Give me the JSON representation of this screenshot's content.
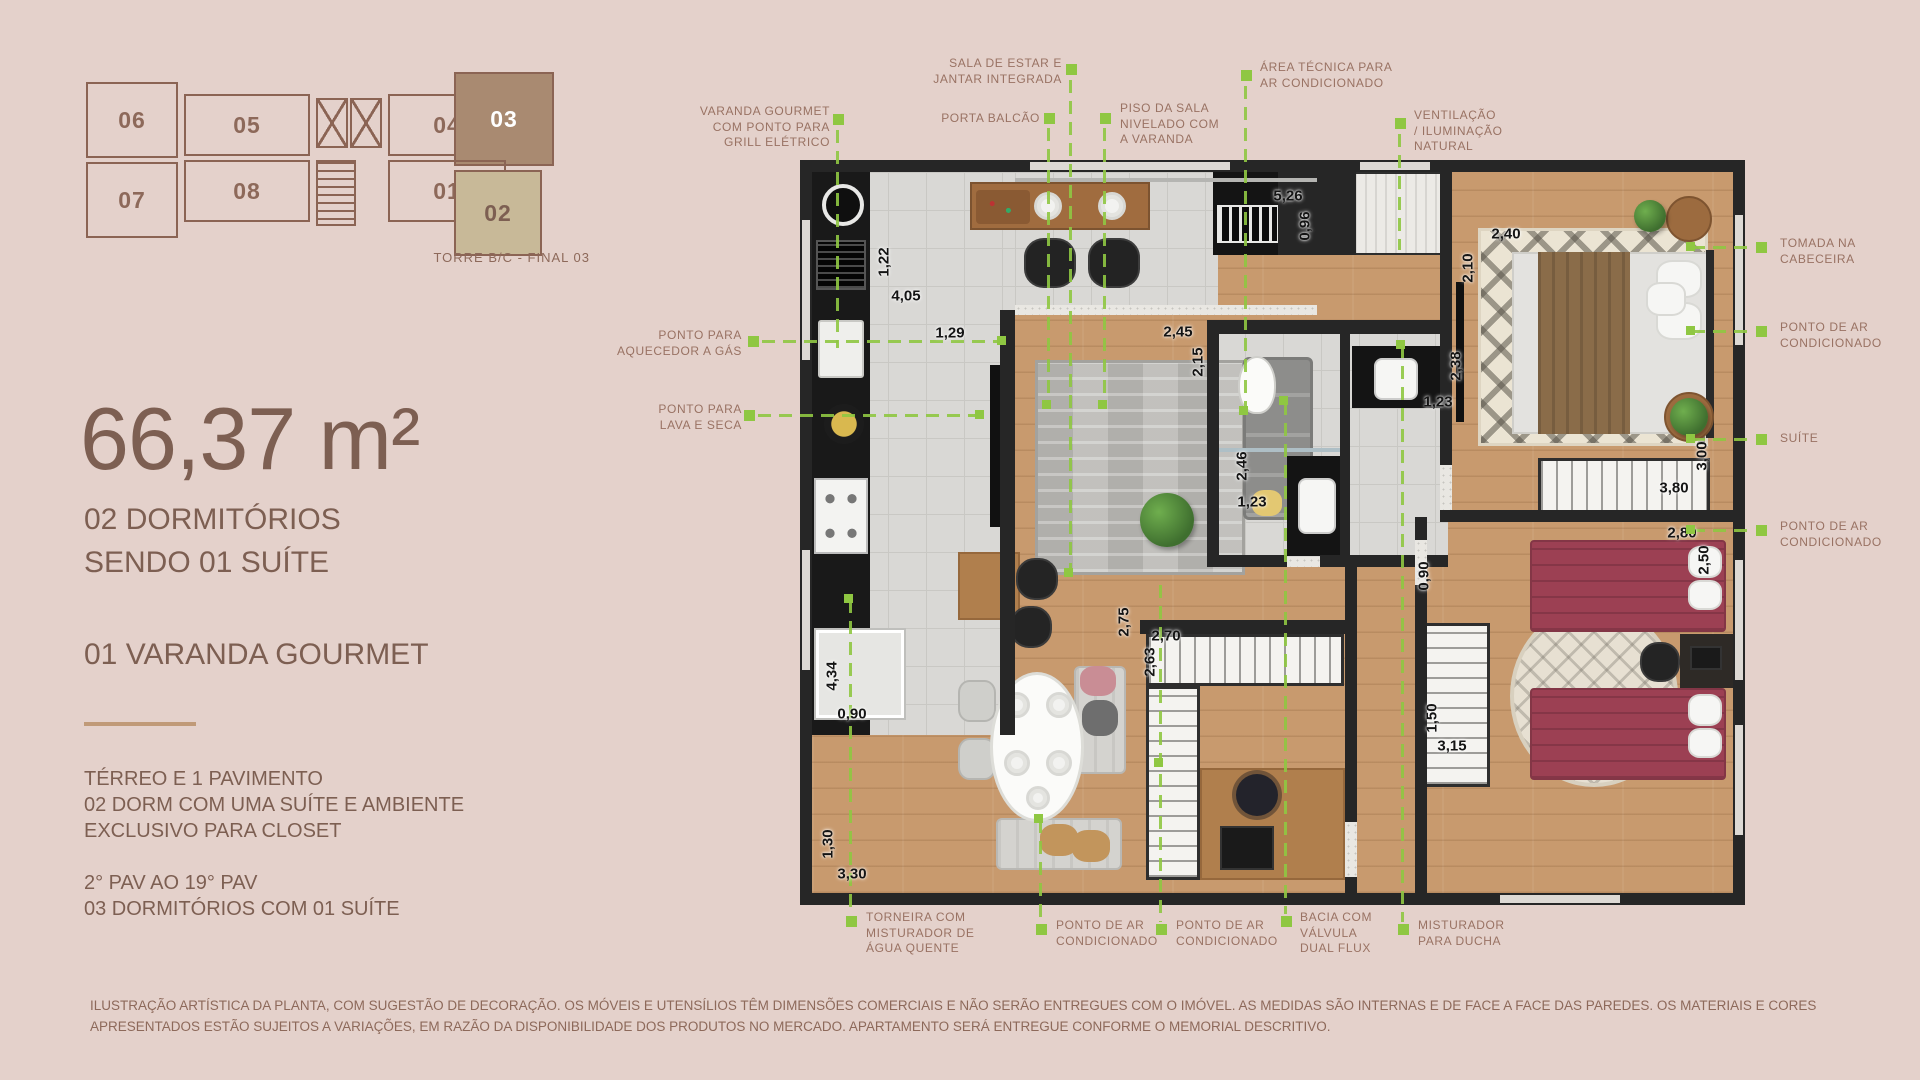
{
  "palette": {
    "background": "#e4d1cb",
    "text_primary": "#7d5f52",
    "text_muted": "#997263",
    "accent_green": "#8fc742",
    "wall": "#262626",
    "unit_highlight": "#a98a71",
    "unit_secondary": "#c8b998"
  },
  "key_plan": {
    "caption": "TORRE B/C - FINAL 03",
    "units": [
      {
        "label": "06",
        "x": 16,
        "y": 16,
        "w": 92,
        "h": 76,
        "style": "outline"
      },
      {
        "label": "05",
        "x": 114,
        "y": 28,
        "w": 126,
        "h": 62,
        "style": "outline"
      },
      {
        "label": "04",
        "x": 318,
        "y": 28,
        "w": 118,
        "h": 62,
        "style": "outline"
      },
      {
        "label": "03",
        "x": 384,
        "y": 6,
        "w": 100,
        "h": 94,
        "style": "primary"
      },
      {
        "label": "07",
        "x": 16,
        "y": 96,
        "w": 92,
        "h": 76,
        "style": "outline"
      },
      {
        "label": "08",
        "x": 114,
        "y": 94,
        "w": 126,
        "h": 62,
        "style": "outline"
      },
      {
        "label": "01",
        "x": 318,
        "y": 94,
        "w": 118,
        "h": 62,
        "style": "outline"
      },
      {
        "label": "02",
        "x": 384,
        "y": 104,
        "w": 88,
        "h": 86,
        "style": "secondary"
      }
    ]
  },
  "panel": {
    "area": "66,37 m²",
    "headline": "02 DORMITÓRIOS\nSENDO 01 SUÍTE",
    "feature": "01 VARANDA GOURMET",
    "floors_block_1": "TÉRREO E 1 PAVIMENTO\n02 DORM COM UMA SUÍTE E AMBIENTE\nEXCLUSIVO PARA  CLOSET",
    "floors_block_2": "2° PAV AO 19° PAV\n03 DORMITÓRIOS COM 01 SUÍTE",
    "disclaimer": "ILUSTRAÇÃO ARTÍSTICA DA PLANTA, COM SUGESTÃO DE DECORAÇÃO. OS MÓVEIS E UTENSÍLIOS TÊM DIMENSÕES COMERCIAIS E NÃO SERÃO ENTREGUES COM O IMÓVEL. AS MEDIDAS SÃO INTERNAS E DE FACE A FACE DAS PAREDES. OS MATERIAIS E CORES APRESENTADOS ESTÃO SUJEITOS A VARIAÇÕES, EM RAZÃO DA DISPONIBILIDADE DOS PRODUTOS NO MERCADO. APARTAMENTO SERÁ ENTREGUE CONFORME O MEMORIAL DESCRITIVO."
  },
  "callouts": [
    {
      "name": "varanda-gourmet",
      "text": "VARANDA GOURMET\nCOM PONTO PARA\nGRILL ELÉTRICO",
      "x": 630,
      "y": 104,
      "w": 200,
      "align": "right",
      "marker": {
        "x": 833,
        "y": 114
      },
      "line": {
        "dir": "v",
        "x": 836,
        "y": 130,
        "len": 218
      }
    },
    {
      "name": "sala-estar-jantar",
      "text": "SALA DE ESTAR E\nJANTAR INTEGRADA",
      "x": 912,
      "y": 56,
      "w": 150,
      "align": "right",
      "marker": {
        "x": 1066,
        "y": 64
      },
      "line": {
        "dir": "v",
        "x": 1069,
        "y": 80,
        "len": 495
      },
      "end": {
        "x": 1064,
        "y": 568
      }
    },
    {
      "name": "porta-balcao",
      "text": "PORTA BALCÃO",
      "x": 890,
      "y": 111,
      "w": 150,
      "align": "right",
      "marker": {
        "x": 1044,
        "y": 113
      },
      "line": {
        "dir": "v",
        "x": 1047,
        "y": 128,
        "len": 278
      },
      "end": {
        "x": 1042,
        "y": 400
      }
    },
    {
      "name": "piso-sala",
      "text": "PISO DA SALA\nNIVELADO COM\nA VARANDA",
      "x": 1120,
      "y": 101,
      "w": 130,
      "align": "left",
      "marker": {
        "x": 1100,
        "y": 113
      },
      "line": {
        "dir": "v",
        "x": 1103,
        "y": 128,
        "len": 278
      },
      "end": {
        "x": 1098,
        "y": 400
      }
    },
    {
      "name": "area-tecnica",
      "text": "ÁREA TÉCNICA PARA\nAR CONDICIONADO",
      "x": 1260,
      "y": 60,
      "w": 190,
      "align": "left",
      "marker": {
        "x": 1241,
        "y": 70
      },
      "line": {
        "dir": "v",
        "x": 1244,
        "y": 86,
        "len": 325
      },
      "end": {
        "x": 1239,
        "y": 406
      }
    },
    {
      "name": "ventilacao-natural",
      "text": "VENTILAÇÃO\n/ ILUMINAÇÃO\nNATURAL",
      "x": 1414,
      "y": 108,
      "w": 130,
      "align": "left",
      "marker": {
        "x": 1395,
        "y": 118
      },
      "line": {
        "dir": "v",
        "x": 1398,
        "y": 134,
        "len": 116
      }
    },
    {
      "name": "tomada-cabeceira",
      "text": "TOMADA NA\nCABECEIRA",
      "x": 1780,
      "y": 236,
      "w": 140,
      "align": "left",
      "marker": {
        "x": 1756,
        "y": 242
      },
      "line": {
        "dir": "h",
        "x": 1692,
        "y": 246,
        "len": 62
      },
      "end": {
        "x": 1686,
        "y": 242
      }
    },
    {
      "name": "ponto-ar-suite",
      "text": "PONTO DE AR\nCONDICIONADO",
      "x": 1780,
      "y": 320,
      "w": 150,
      "align": "left",
      "marker": {
        "x": 1756,
        "y": 326
      },
      "line": {
        "dir": "h",
        "x": 1692,
        "y": 330,
        "len": 62
      },
      "end": {
        "x": 1686,
        "y": 326
      }
    },
    {
      "name": "suite",
      "text": "SUÍTE",
      "x": 1780,
      "y": 431,
      "w": 120,
      "align": "left",
      "marker": {
        "x": 1756,
        "y": 434
      },
      "line": {
        "dir": "h",
        "x": 1692,
        "y": 438,
        "len": 62
      },
      "end": {
        "x": 1686,
        "y": 434
      }
    },
    {
      "name": "ponto-ar-dorm2",
      "text": "PONTO DE AR\nCONDICIONADO",
      "x": 1780,
      "y": 519,
      "w": 150,
      "align": "left",
      "marker": {
        "x": 1756,
        "y": 525
      },
      "line": {
        "dir": "h",
        "x": 1692,
        "y": 529,
        "len": 62
      },
      "end": {
        "x": 1686,
        "y": 525
      }
    },
    {
      "name": "aquecedor-gas",
      "text": "PONTO PARA\nAQUECEDOR A GÁS",
      "x": 570,
      "y": 328,
      "w": 172,
      "align": "right",
      "marker": {
        "x": 748,
        "y": 336
      },
      "line": {
        "dir": "h",
        "x": 762,
        "y": 340,
        "len": 240
      },
      "end": {
        "x": 997,
        "y": 336
      }
    },
    {
      "name": "lava-seca",
      "text": "PONTO PARA\nLAVA E SECA",
      "x": 570,
      "y": 402,
      "w": 172,
      "align": "right",
      "marker": {
        "x": 744,
        "y": 410
      },
      "line": {
        "dir": "h",
        "x": 758,
        "y": 414,
        "len": 222
      },
      "end": {
        "x": 975,
        "y": 410
      }
    },
    {
      "name": "torneira-agua-quente",
      "text": "TORNEIRA COM\nMISTURADOR DE\nÁGUA QUENTE",
      "x": 866,
      "y": 910,
      "w": 160,
      "align": "left",
      "marker": {
        "x": 846,
        "y": 916
      },
      "line": {
        "dir": "v",
        "x": 849,
        "y": 600,
        "len": 314
      },
      "end": {
        "x": 844,
        "y": 594
      }
    },
    {
      "name": "ponto-ar-sala-1",
      "text": "PONTO DE AR\nCONDICIONADO",
      "x": 1056,
      "y": 918,
      "w": 150,
      "align": "left",
      "marker": {
        "x": 1036,
        "y": 924
      },
      "line": {
        "dir": "v",
        "x": 1039,
        "y": 820,
        "len": 102
      },
      "end": {
        "x": 1034,
        "y": 814
      }
    },
    {
      "name": "ponto-ar-sala-2",
      "text": "PONTO DE AR\nCONDICIONADO",
      "x": 1176,
      "y": 918,
      "w": 150,
      "align": "left",
      "marker": {
        "x": 1156,
        "y": 924
      },
      "line": {
        "dir": "v",
        "x": 1159,
        "y": 585,
        "len": 337
      },
      "end": {
        "x": 1154,
        "y": 758
      }
    },
    {
      "name": "bacia-dual-flux",
      "text": "BACIA COM\nVÁLVULA\nDUAL FLUX",
      "x": 1300,
      "y": 910,
      "w": 130,
      "align": "left",
      "marker": {
        "x": 1281,
        "y": 916
      },
      "line": {
        "dir": "v",
        "x": 1284,
        "y": 402,
        "len": 512
      },
      "end": {
        "x": 1279,
        "y": 396
      }
    },
    {
      "name": "misturador-ducha",
      "text": "MISTURADOR\nPARA DUCHA",
      "x": 1418,
      "y": 918,
      "w": 140,
      "align": "left",
      "marker": {
        "x": 1398,
        "y": 924
      },
      "line": {
        "dir": "v",
        "x": 1401,
        "y": 345,
        "len": 577
      },
      "end": {
        "x": 1396,
        "y": 340
      }
    }
  ],
  "dimensions": [
    {
      "v": "5,26",
      "x": 1288,
      "y": 196,
      "r": 0
    },
    {
      "v": "0,96",
      "x": 1305,
      "y": 226,
      "r": 90
    },
    {
      "v": "2,40",
      "x": 1506,
      "y": 234,
      "r": 0
    },
    {
      "v": "2,10",
      "x": 1468,
      "y": 268,
      "r": 90
    },
    {
      "v": "1,22",
      "x": 884,
      "y": 262,
      "r": 90
    },
    {
      "v": "4,05",
      "x": 906,
      "y": 296,
      "r": 0
    },
    {
      "v": "1,29",
      "x": 950,
      "y": 333,
      "r": 0
    },
    {
      "v": "2,45",
      "x": 1178,
      "y": 332,
      "r": 0
    },
    {
      "v": "2,15",
      "x": 1198,
      "y": 362,
      "r": 90
    },
    {
      "v": "2,38",
      "x": 1456,
      "y": 366,
      "r": 90
    },
    {
      "v": "1,23",
      "x": 1438,
      "y": 402,
      "r": 0
    },
    {
      "v": "3,00",
      "x": 1702,
      "y": 456,
      "r": 90
    },
    {
      "v": "3,80",
      "x": 1674,
      "y": 488,
      "r": 0
    },
    {
      "v": "2,80",
      "x": 1682,
      "y": 533,
      "r": 0
    },
    {
      "v": "2,50",
      "x": 1704,
      "y": 560,
      "r": 90
    },
    {
      "v": "2,46",
      "x": 1242,
      "y": 466,
      "r": 90
    },
    {
      "v": "1,23",
      "x": 1252,
      "y": 502,
      "r": 0
    },
    {
      "v": "0,90",
      "x": 1424,
      "y": 576,
      "r": 90
    },
    {
      "v": "2,75",
      "x": 1124,
      "y": 622,
      "r": 90
    },
    {
      "v": "2,70",
      "x": 1166,
      "y": 636,
      "r": 0
    },
    {
      "v": "2,63",
      "x": 1150,
      "y": 662,
      "r": 90
    },
    {
      "v": "4,34",
      "x": 832,
      "y": 676,
      "r": 90
    },
    {
      "v": "0,90",
      "x": 852,
      "y": 714,
      "r": 0
    },
    {
      "v": "1,50",
      "x": 1432,
      "y": 718,
      "r": 90
    },
    {
      "v": "3,15",
      "x": 1452,
      "y": 746,
      "r": 0
    },
    {
      "v": "1,30",
      "x": 828,
      "y": 844,
      "r": 90
    },
    {
      "v": "3,30",
      "x": 852,
      "y": 874,
      "r": 0
    }
  ]
}
